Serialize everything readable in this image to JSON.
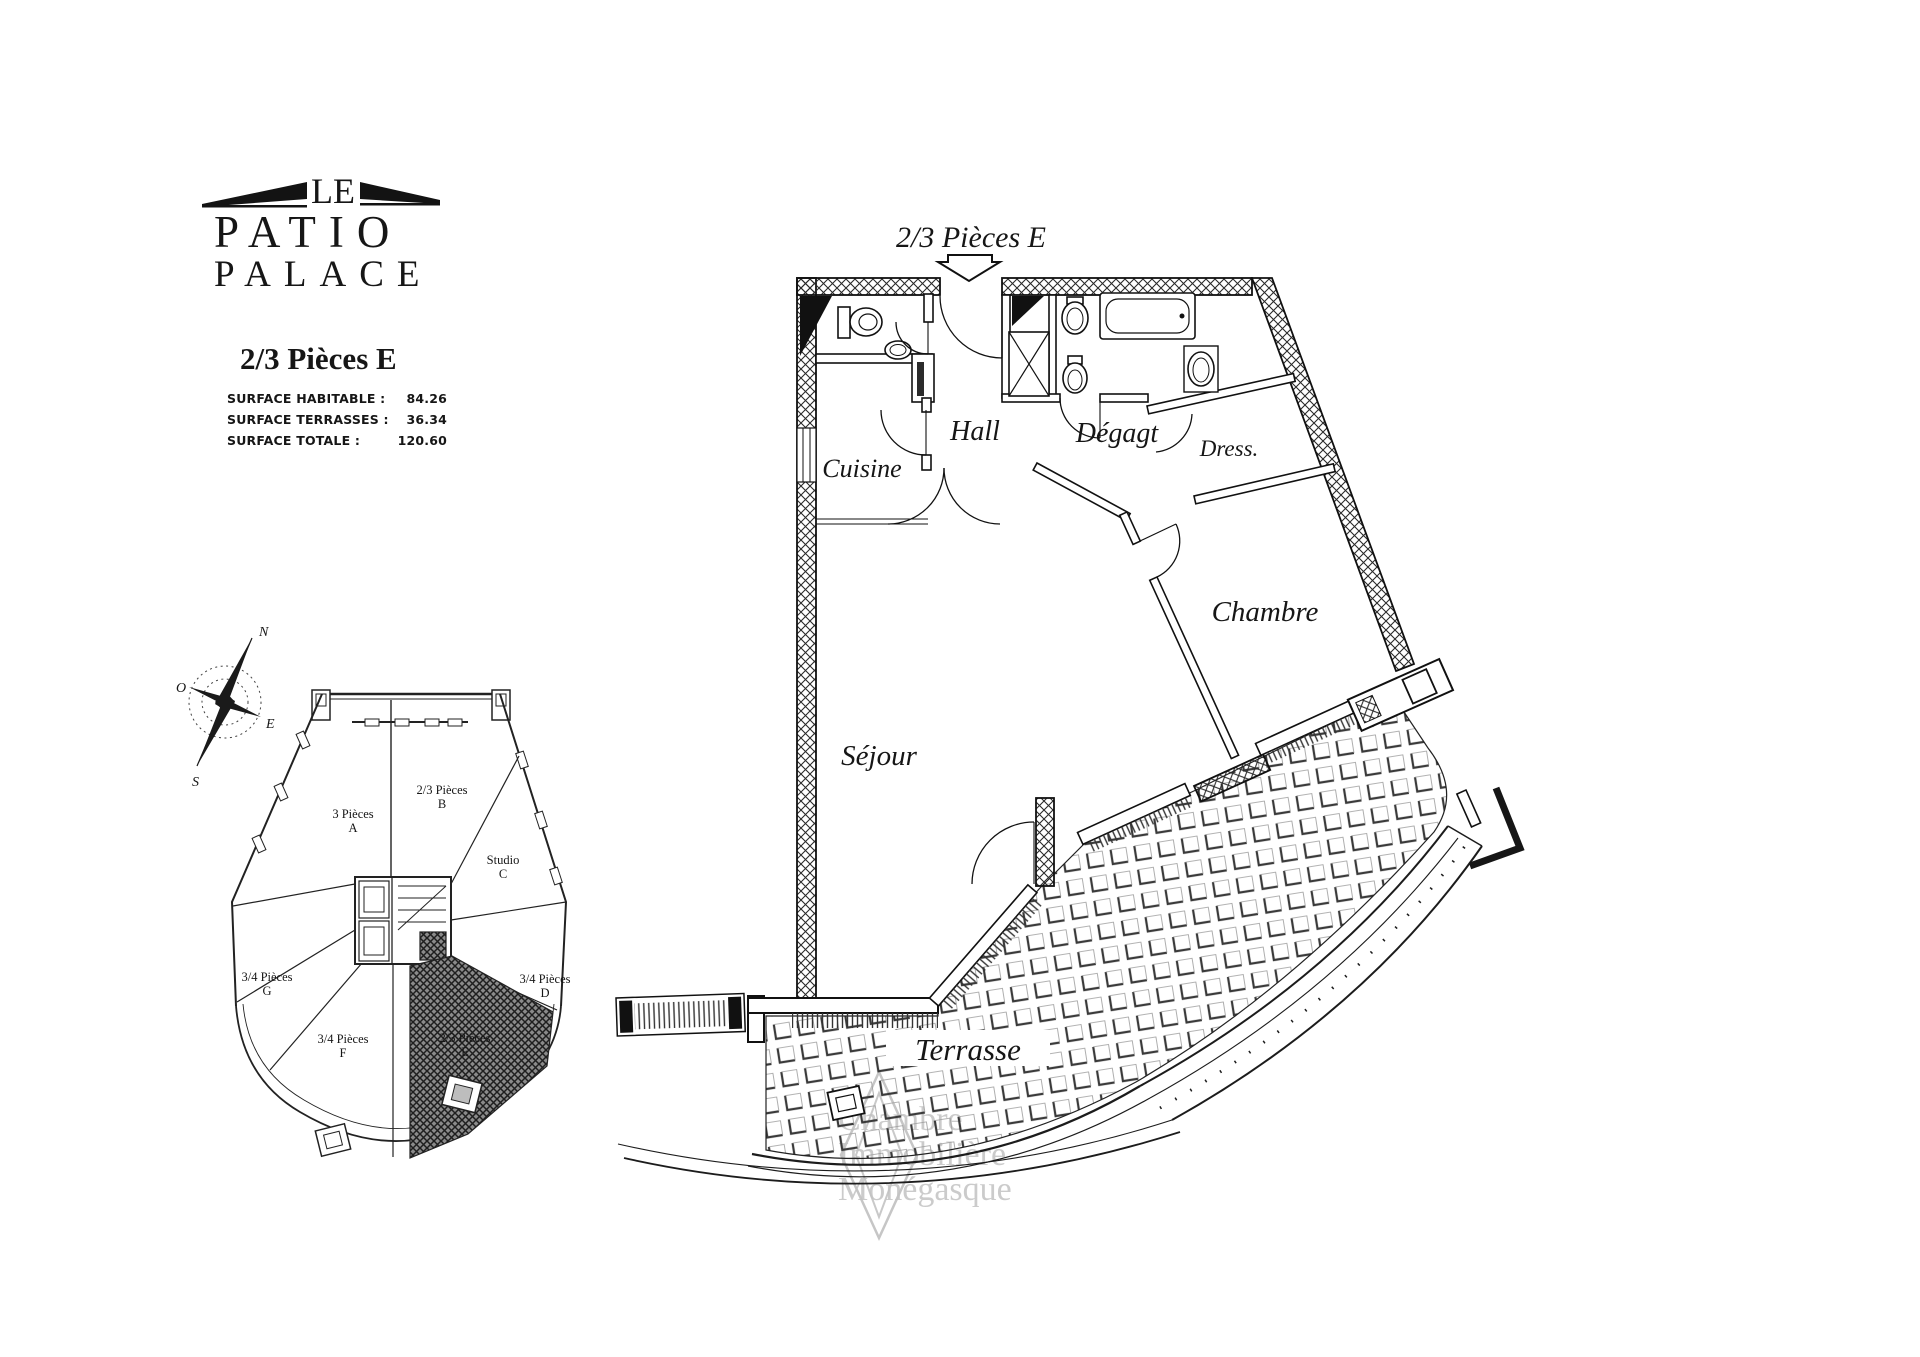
{
  "branding": {
    "le": "LE",
    "patio": "PATIO",
    "palace": "PALACE"
  },
  "unit": {
    "title": "2/3 Pièces E",
    "surfaces": [
      {
        "label": "SURFACE HABITABLE :",
        "value": "84.26"
      },
      {
        "label": "SURFACE TERRASSES :",
        "value": "36.34"
      },
      {
        "label": "SURFACE TOTALE :",
        "value": "120.60"
      }
    ]
  },
  "plan": {
    "title": "2/3 Pièces E",
    "rooms": {
      "cuisine": "Cuisine",
      "hall": "Hall",
      "degagt": "Dégagt",
      "dress": "Dress.",
      "chambre": "Chambre",
      "sejour": "Séjour",
      "terrasse": "Terrasse"
    }
  },
  "compass": {
    "n": "N",
    "s": "S",
    "e": "E",
    "o": "O"
  },
  "overview": {
    "highlighted": "E",
    "units": [
      {
        "name": "3 Pièces",
        "letter": "A"
      },
      {
        "name": "2/3 Pièces",
        "letter": "B"
      },
      {
        "name": "Studio",
        "letter": "C"
      },
      {
        "name": "3/4 Pièces",
        "letter": "D"
      },
      {
        "name": "2/3 Pièces",
        "letter": "E"
      },
      {
        "name": "3/4 Pièces",
        "letter": "F"
      },
      {
        "name": "3/4 Pièces",
        "letter": "G"
      }
    ]
  },
  "watermark": {
    "line1": "Chambre",
    "line2": "Immobilière",
    "line3": "Monégasque"
  },
  "colors": {
    "ink": "#161616",
    "watermark": "#c3c3c3"
  }
}
